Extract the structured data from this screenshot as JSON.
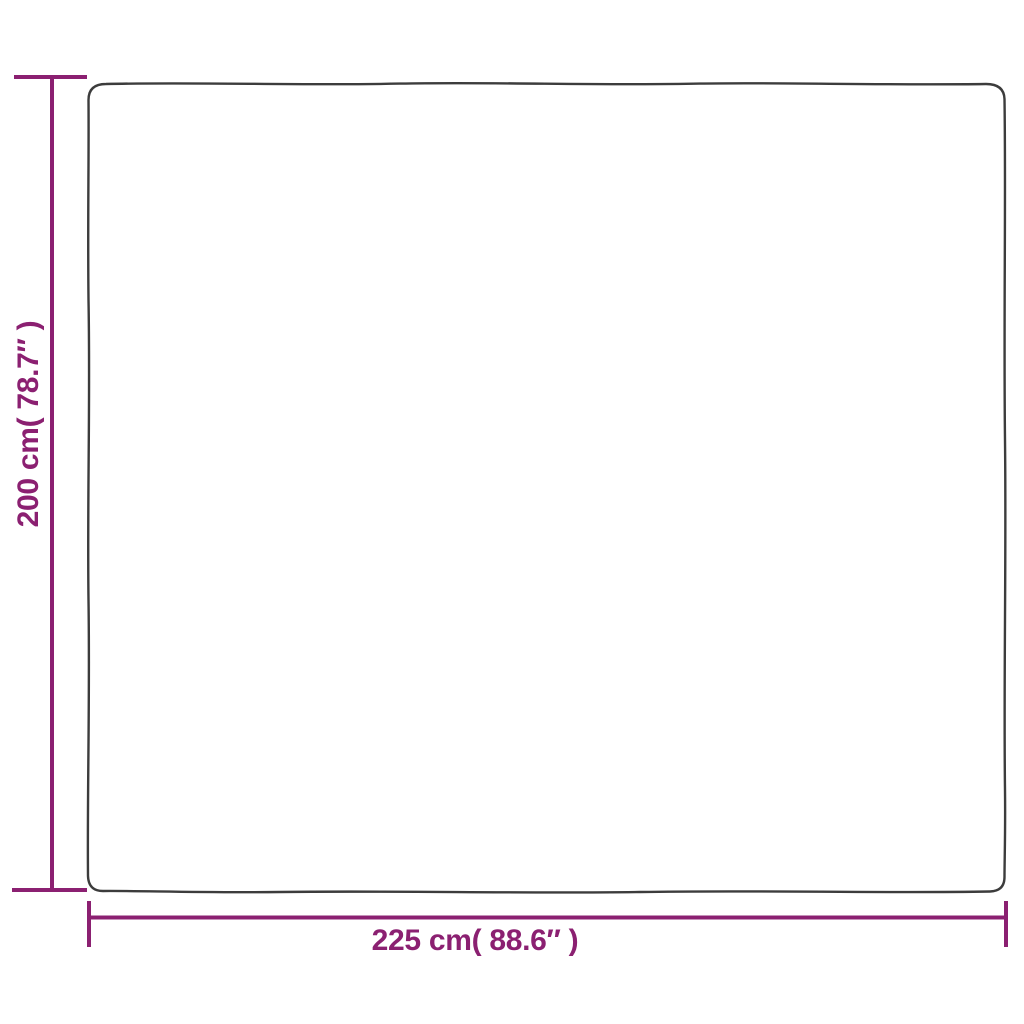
{
  "diagram": {
    "title": "product-dimension-diagram",
    "accent_color": "#8B2071",
    "outline_color": "#3C3C3C",
    "background_color": "#ffffff",
    "height_dimension": {
      "label": "200 cm( 78.7″ )",
      "value_cm": 200,
      "value_inch": 78.7
    },
    "width_dimension": {
      "label": "225 cm( 88.6″ )",
      "value_cm": 225,
      "value_inch": 88.6
    }
  }
}
